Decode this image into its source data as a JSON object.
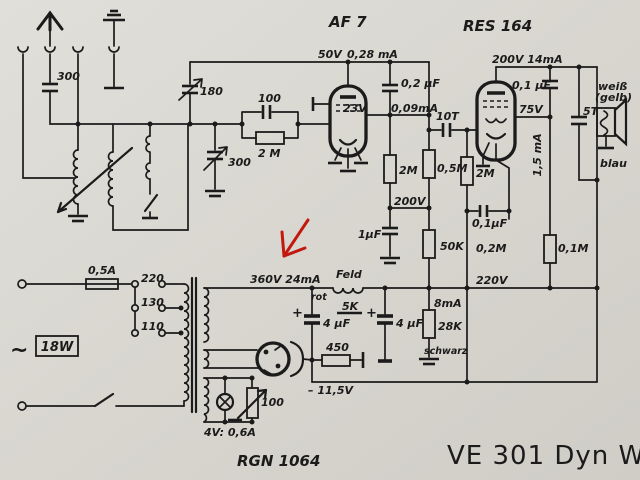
{
  "title": "VE 301 Dyn W",
  "colors": {
    "paper": "#d9d7d0",
    "ink": "#1b1b1b",
    "annotation_red": "#c2190f"
  },
  "tubes": {
    "af7": "AF 7",
    "res164": "RES 164",
    "rectifier": "RGN 1064"
  },
  "labels": {
    "c300_ant": "300",
    "c180": "180",
    "c300_tune": "300",
    "c100": "100",
    "r2m_grid": "2 M",
    "v50": "50V",
    "i028": "0,28 mA",
    "c02uf": "0,2 µF",
    "v23": "23V",
    "i009": "0,09mA",
    "c10t": "10T",
    "r2m_a": "2M",
    "r05m": "0,5M",
    "r2m_b": "2M",
    "v200": "200V",
    "c1uf": "1µF",
    "r50k": "50K",
    "c01uf_b": "0,1µF",
    "r02m": "0,2M",
    "r01m": "0,1M",
    "v200_14": "200V 14mA",
    "c01uf_a": "0,1 µF",
    "v75": "75V",
    "i15": "1,5 mA",
    "c5t": "5T",
    "weiss": "weiß",
    "gelb": "(gelb)",
    "blau": "blau",
    "v220": "220V",
    "v360": "360V 24mA",
    "rot": "rot",
    "feld": "Feld",
    "r5k": "5K",
    "plus_a": "+",
    "c4uf_a": "4 µF",
    "plus_b": "+",
    "c4uf_b": "4 µF",
    "r450": "450",
    "v_bias": "– 11,5V",
    "i8": "8mA",
    "r28k": "28K",
    "schwarz": "schwarz",
    "fuse": "0,5A",
    "tap220": "220",
    "tap130": "130",
    "tap110": "110",
    "w18": "18W",
    "ac": "~",
    "heater": "4V: 0,6A",
    "pot100": "100"
  }
}
